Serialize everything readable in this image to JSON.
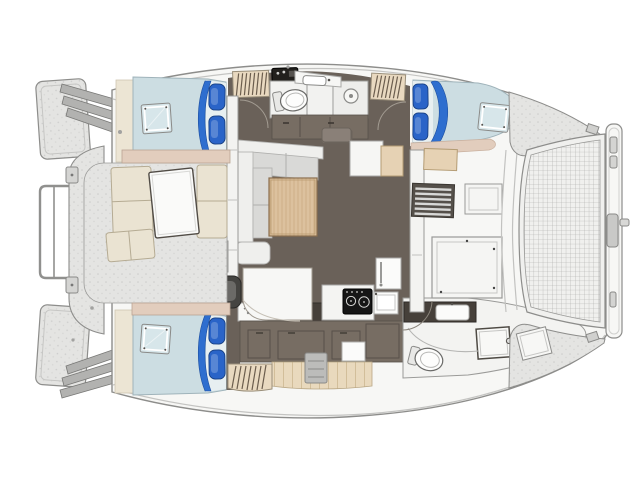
{
  "vessel": {
    "kind": "catamaran-yacht-floor-plan",
    "view": "top-down deck plan",
    "orientation": "bow-right-stern-left"
  },
  "areas": {
    "stern": [
      "transom-platform-port",
      "transom-platform-starboard",
      "transom-steps-port",
      "transom-steps-starboard",
      "davit-frame",
      "aft-platform"
    ],
    "cockpit": [
      "bench-port",
      "bench-forward",
      "bench-starboard",
      "cockpit-table",
      "storage-lockers",
      "companionway-steps",
      "nav-seat",
      "nav-desk"
    ],
    "port_hull": [
      "aft-cabin-double-berth",
      "deck-hatch",
      "wardrobe-louver-aft",
      "head-toilet",
      "head-vanity-sink",
      "shower-drain",
      "cabinet-run",
      "wardrobe-louver-forward",
      "forward-cabin-double-berth",
      "forward-deck-hatch"
    ],
    "starboard_hull": [
      "aft-cabin-double-berth",
      "deck-hatch",
      "vanity-desk",
      "galley-sink-counter",
      "galley-counter-dark",
      "stove-cooktop",
      "galley-sink-module",
      "refrigerator",
      "appliance",
      "wood-sole",
      "curved-steps",
      "head-vanity",
      "head-toilet",
      "shower-stall"
    ],
    "salon": [
      "l-shaped-sofa",
      "dining-table",
      "side-bench",
      "white-cabinet",
      "wood-cabinet",
      "aft-bulkhead-door",
      "forward-bulkhead-door"
    ],
    "foredeck": [
      "louver-vent",
      "large-deck-hatch",
      "small-deck-hatch",
      "wood-module",
      "walkway",
      "trampoline-net",
      "bow-crossbeam",
      "crossbeam-latch",
      "anchor-pin",
      "bow-deck-port",
      "bow-deck-starboard",
      "deck-hatch-tilted"
    ]
  },
  "colors": {
    "deck_white": "#f7f7f5",
    "outline": "#8d8d8b",
    "interior_floor": "#6a6159",
    "cabinet": "#776d63",
    "cabinet_dark": "#46403a",
    "mattress": "#ccdde2",
    "mattress_light": "#e7eff1",
    "pillow": "#2a64c8",
    "blanket": "#2e6ecf",
    "hatch_glass": "#d7e6ea",
    "trim_beige": "#e2cdbd",
    "wall_cream": "#ece5d4",
    "seat_cream": "#eae3d2",
    "sofa_frame": "#efefed",
    "sofa_cushion": "#d9d9d7",
    "wood_table": "#dcc19e",
    "wood_module": "#e6d2b4",
    "louver": "#e9d9c0",
    "mesh_bg": "#f0f0ee",
    "stove": "#161616",
    "fixture_white": "#fbfbfa",
    "steps_gray": "#bcbcba",
    "chair_dark": "#454441"
  },
  "counts": {
    "berths": 3,
    "heads": 2,
    "pillows_per_berth": 2
  }
}
